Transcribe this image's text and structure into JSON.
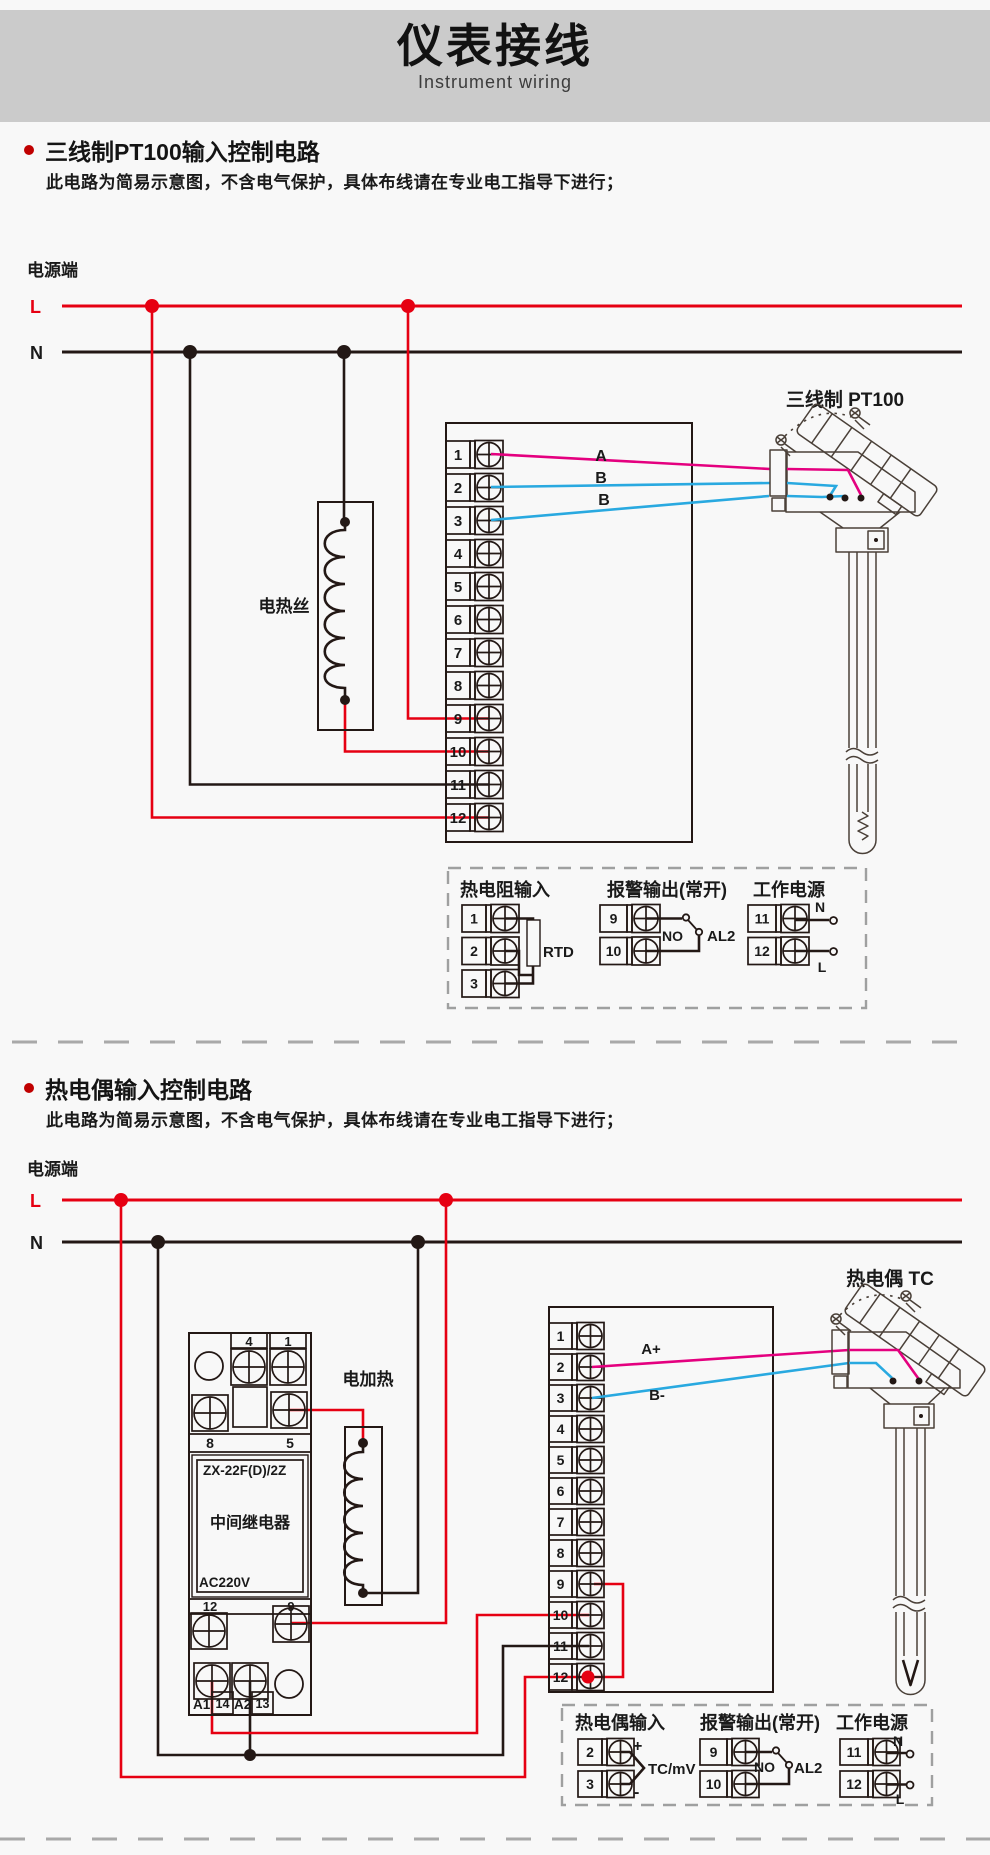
{
  "header": {
    "title": "仪表接线",
    "subtitle": "Instrument wiring"
  },
  "colors": {
    "line_red": "#e60012",
    "wire_magenta": "#e4007f",
    "wire_blue": "#29a9e0",
    "ink": "#231815",
    "header_bg": "#cbcbcb",
    "page_bg": "#f8f8f8",
    "bullet": "#c00000"
  },
  "section1": {
    "title": "三线制PT100输入控制电路",
    "note": "此电路为简易示意图，不含电气保护，具体布线请在专业电工指导下进行；"
  },
  "section2": {
    "title": "热电偶输入控制电路",
    "note": "此电路为简易示意图，不含电气保护，具体布线请在专业电工指导下进行；"
  },
  "d1": {
    "power": "电源端",
    "l": "L",
    "n": "N",
    "heater": "电热丝",
    "sensor": "三线制 PT100",
    "wires": [
      "A",
      "B",
      "B"
    ],
    "terminals": [
      "1",
      "2",
      "3",
      "4",
      "5",
      "6",
      "7",
      "8",
      "9",
      "10",
      "11",
      "12"
    ]
  },
  "lg1": {
    "rtd_title": "热电阻输入",
    "t_rtd": [
      "1",
      "2",
      "3"
    ],
    "rtd": "RTD",
    "alarm_title": "报警输出(常开)",
    "t_alarm": [
      "9",
      "10"
    ],
    "no": "NO",
    "al2": "AL2",
    "power_title": "工作电源",
    "t_power": [
      "11",
      "12"
    ],
    "n": "N",
    "l": "L"
  },
  "d2": {
    "power": "电源端",
    "l": "L",
    "n": "N",
    "heater": "电加热",
    "sensor": "热电偶 TC",
    "wires": [
      "A+",
      "B-"
    ],
    "terminals": [
      "1",
      "2",
      "3",
      "4",
      "5",
      "6",
      "7",
      "8",
      "9",
      "10",
      "11",
      "12"
    ],
    "relay": {
      "model": "ZX-22F(D)/2Z",
      "name": "中间继电器",
      "volt": "AC220V",
      "top": [
        "4",
        "1"
      ],
      "mid": [
        "8",
        "5"
      ],
      "low": [
        "12",
        "9"
      ],
      "coil": [
        "A1",
        "14",
        "A2",
        "13"
      ]
    }
  },
  "lg2": {
    "tc_title": "热电偶输入",
    "t_tc": [
      "2",
      "3"
    ],
    "plus": "+",
    "minus": "-",
    "tc": "TC/mV",
    "alarm_title": "报警输出(常开)",
    "t_alarm": [
      "9",
      "10"
    ],
    "no": "NO",
    "al2": "AL2",
    "power_title": "工作电源",
    "t_power": [
      "11",
      "12"
    ],
    "n": "N",
    "l": "L"
  }
}
